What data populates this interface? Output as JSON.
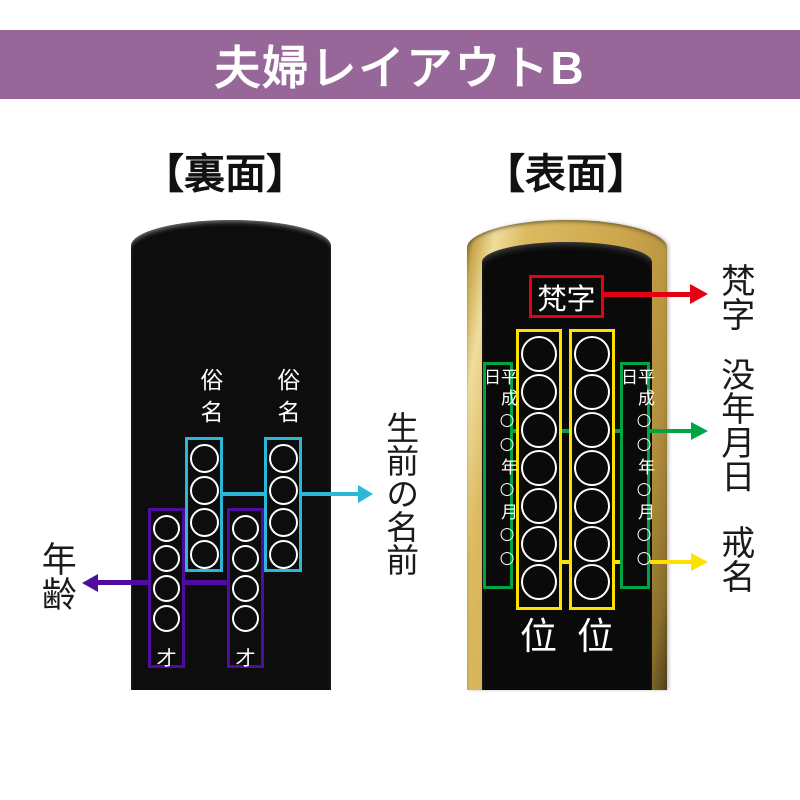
{
  "header": {
    "title": "夫婦レイアウトB"
  },
  "panels": {
    "back": {
      "caption": "【裏面】",
      "name_column_label": "俗名",
      "age_suffix_char": "才",
      "name_circle_count": 4,
      "age_circle_count": 4,
      "annotations": {
        "living_name": "生前の名前",
        "age": "年齢"
      }
    },
    "front": {
      "caption": "【表面】",
      "bonji_text": "梵字",
      "date_column_text": "平成○○年○月○○日",
      "kaimyo_circle_count": 7,
      "rank_char": "位",
      "annotations": {
        "bonji": "梵字",
        "death_date": "没年月日",
        "kaimyo": "戒名"
      }
    }
  },
  "colors": {
    "header_band": "#97679a",
    "back_highlight_name": "#2ab7d8",
    "back_highlight_age": "#4f0da0",
    "front_highlight_bonji": "#e50012",
    "front_highlight_date": "#00a443",
    "front_highlight_kaimyo": "#ffe100",
    "tablet_gold": "#cfa94e"
  }
}
